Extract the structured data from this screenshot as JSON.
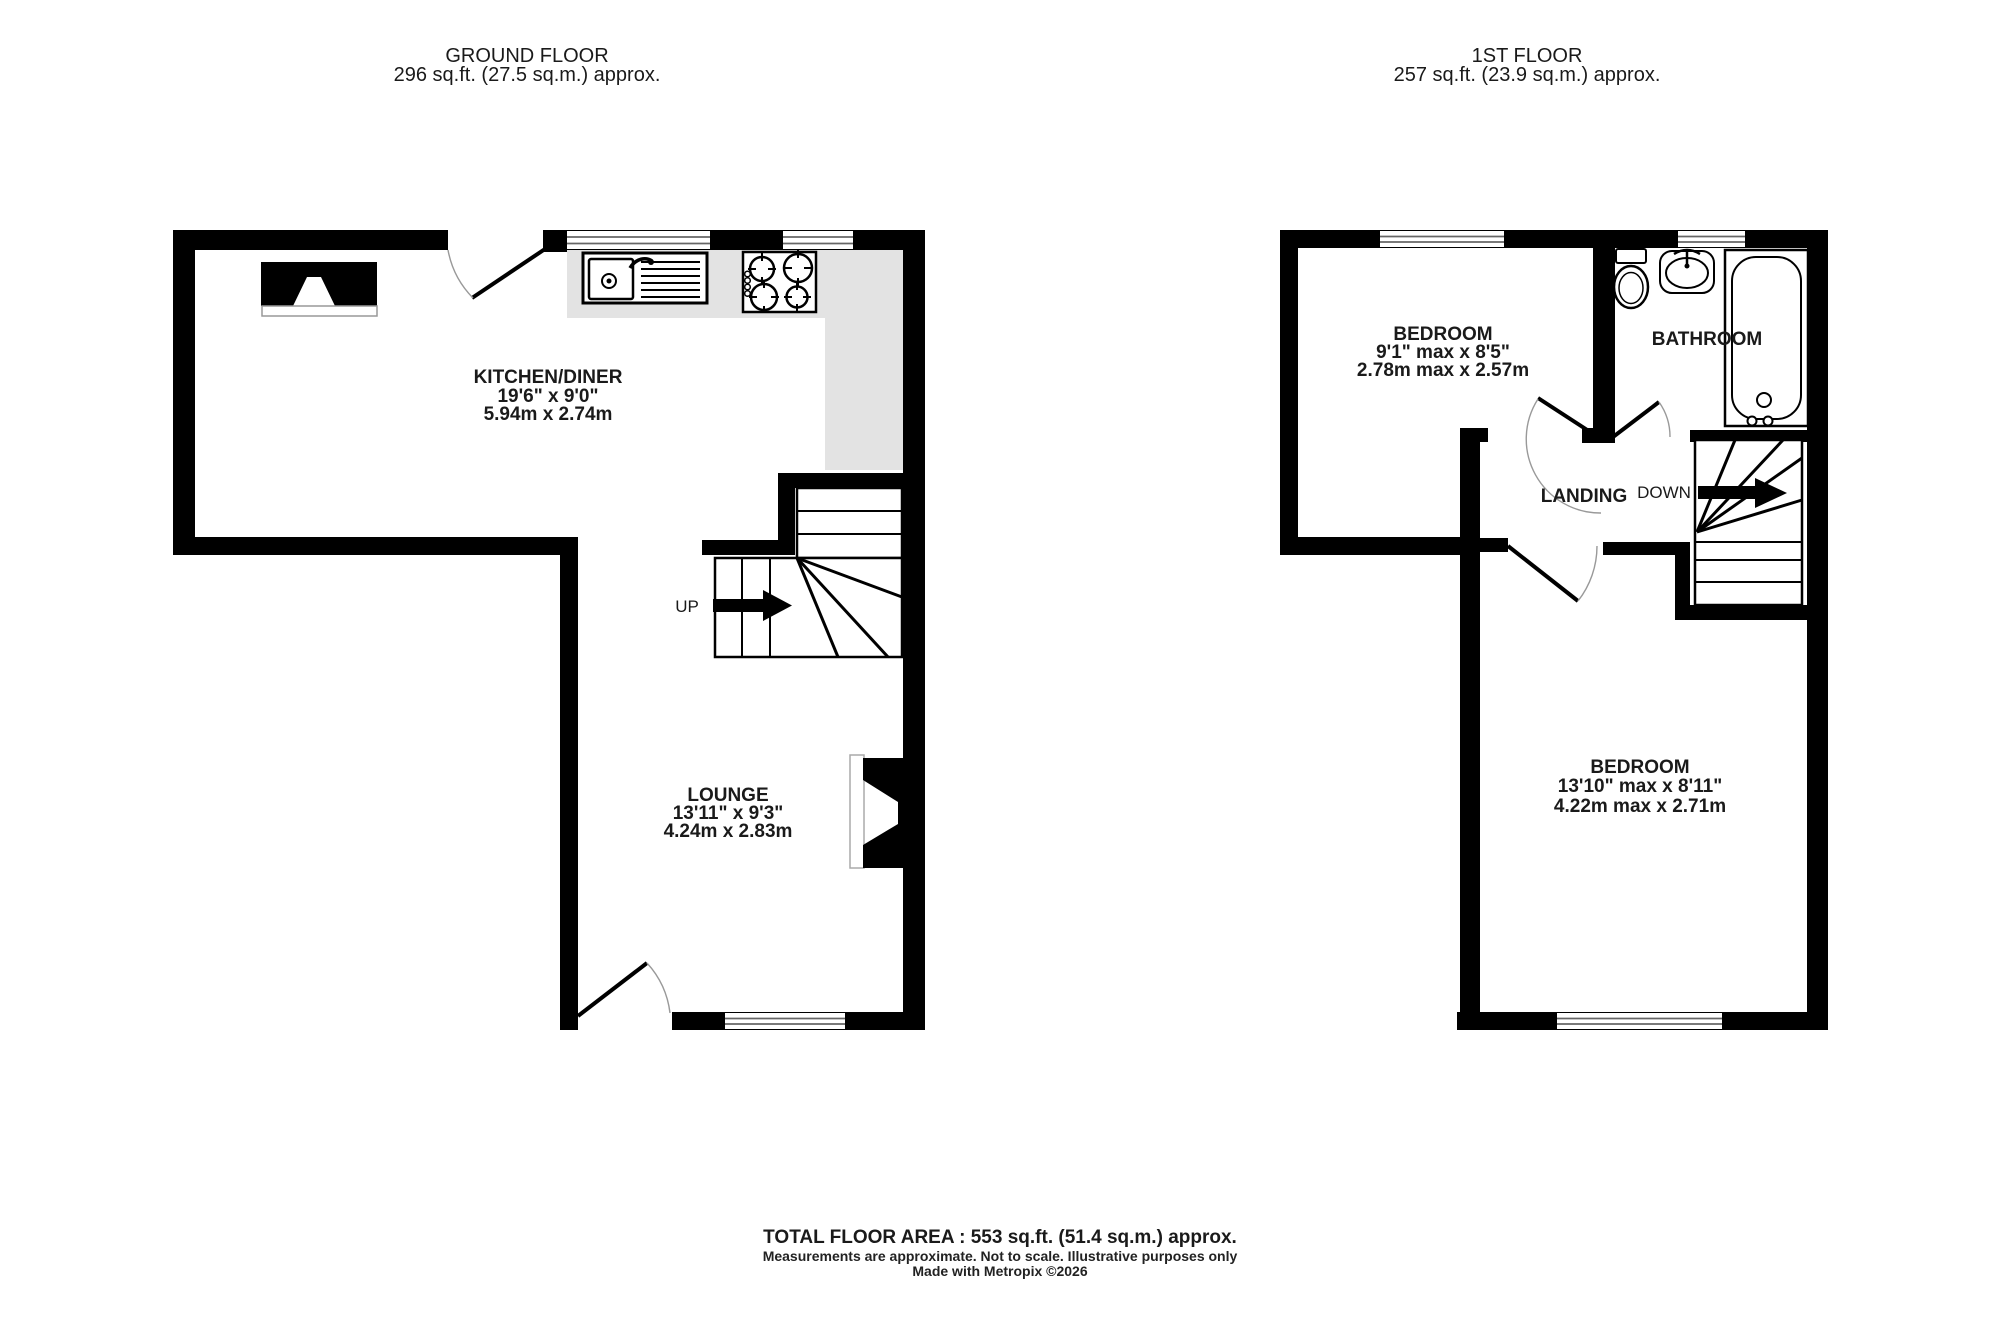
{
  "ground": {
    "header": {
      "title": "GROUND FLOOR",
      "area": "296 sq.ft. (27.5 sq.m.) approx."
    },
    "kitchen": {
      "name": "KITCHEN/DINER",
      "size_imperial": "19'6\"  x 9'0\"",
      "size_metric": "5.94m  x 2.74m"
    },
    "lounge": {
      "name": "LOUNGE",
      "size_imperial": "13'11\"  x 9'3\"",
      "size_metric": "4.24m  x 2.83m"
    },
    "stairs_label": "UP"
  },
  "first": {
    "header": {
      "title": "1ST FLOOR",
      "area": "257 sq.ft. (23.9 sq.m.) approx."
    },
    "bedroom1": {
      "name": "BEDROOM",
      "size_imperial": "9'1\" max x 8'5\"",
      "size_metric": "2.78m max x 2.57m"
    },
    "bathroom": {
      "name": "BATHROOM"
    },
    "landing": {
      "name": "LANDING"
    },
    "stairs_label": "DOWN",
    "bedroom2": {
      "name": "BEDROOM",
      "size_imperial": "13'10\" max x 8'11\"",
      "size_metric": "4.22m max x 2.71m"
    }
  },
  "footer": {
    "total": "TOTAL FLOOR AREA : 553 sq.ft. (51.4 sq.m.) approx.",
    "disclaimer": "Measurements are approximate.  Not to scale.  Illustrative purposes only",
    "credit": "Made with Metropix ©2026"
  },
  "icons": {
    "sink": "sink-with-drainer",
    "hob": "four-burner-hob",
    "toilet": "toilet",
    "basin": "pedestal-basin",
    "bath": "bathtub",
    "up_arrow": "stairs-up-arrow",
    "down_arrow": "stairs-down-arrow"
  },
  "colors": {
    "wall": "#000000",
    "counter": "#e3e3e3",
    "text": "#1a1a1a",
    "window_line": "#666666",
    "door_arc": "#999999"
  }
}
